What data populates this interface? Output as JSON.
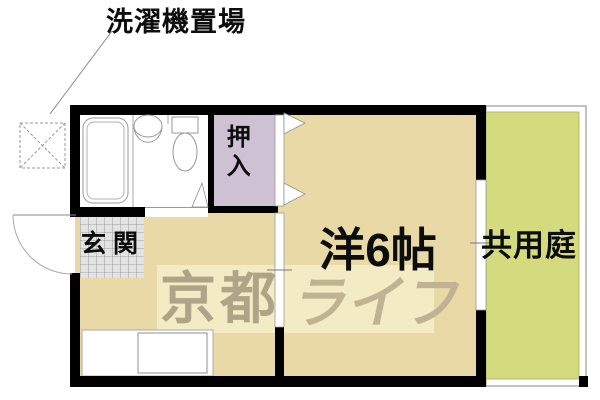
{
  "floorplan": {
    "labels": {
      "washer_area": "洗濯機置場",
      "entrance": "玄関",
      "closet": "押入",
      "main_room": "洋6帖",
      "shared_garden": "共用庭"
    },
    "watermark": {
      "brand_part1": "京都",
      "brand_part2": "ライフ"
    },
    "colors": {
      "wall": "#000000",
      "room_floor": "#e9d9a6",
      "closet_fill": "#cdc1d3",
      "garden_fill": "#d4db7e",
      "tile_fill": "#e3e3e3",
      "watermark_box": "#f5edc9",
      "watermark_text1": "#b0a488",
      "watermark_text2": "#bfb394",
      "fixture_line": "#999999",
      "garden_border": "#9a9a9a"
    }
  }
}
